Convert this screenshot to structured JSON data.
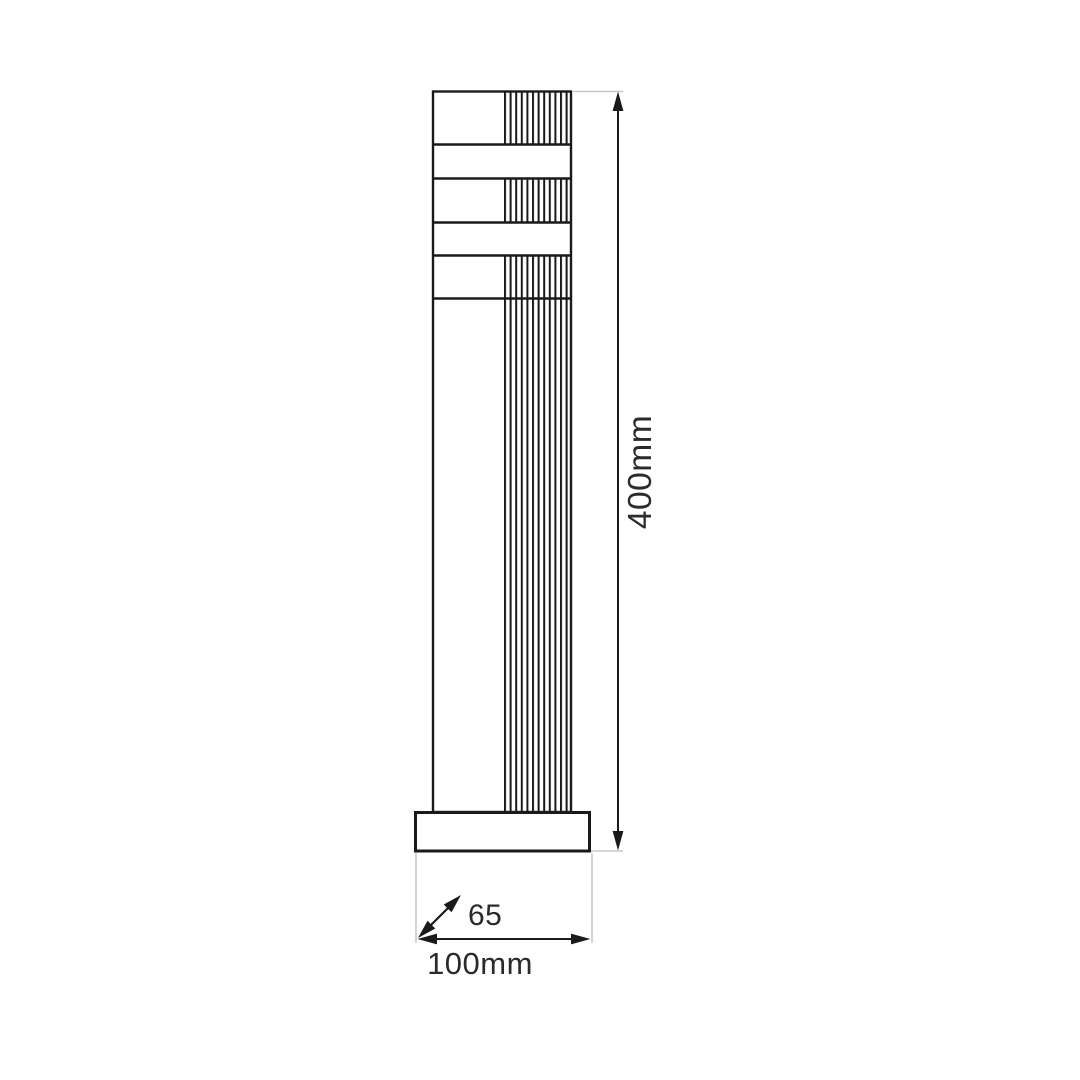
{
  "dimensions": {
    "height_label": "400mm",
    "width_label": "100mm",
    "depth_label": "65"
  },
  "colors": {
    "line": "#1a1a1a",
    "text": "#2b2b2b",
    "extension_line": "#c9c9c9",
    "background": "#ffffff"
  }
}
